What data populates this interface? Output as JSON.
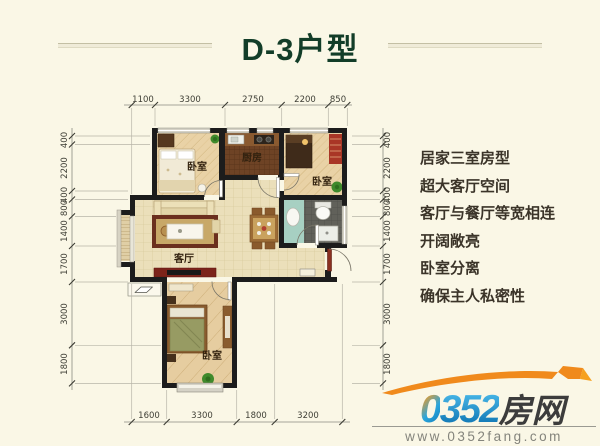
{
  "title": {
    "text": "D-3户型",
    "color": "#123d28"
  },
  "features": [
    "居家三室房型",
    "超大客厅空间",
    "客厅与餐厅等宽相连",
    "开阔敞亮",
    "卧室分离",
    "确保主人私密性"
  ],
  "plan": {
    "rooms": {
      "bedroom_top_left": "卧室",
      "kitchen": "厨房",
      "bedroom_top_right": "卧室",
      "living": "客厅",
      "bedroom_bottom": "卧室"
    },
    "dims": {
      "top": [
        "1100",
        "3300",
        "2750",
        "2200",
        "850"
      ],
      "bottom": [
        "1600",
        "3300",
        "1800",
        "3200"
      ],
      "left": [
        "400",
        "2200",
        "400",
        "800",
        "1400",
        "1700",
        "3000",
        "1800"
      ],
      "right": [
        "400",
        "2200",
        "400",
        "800",
        "1400",
        "1700",
        "3000",
        "1800"
      ]
    }
  },
  "logo": {
    "brand_zero": "0",
    "brand_number": "352",
    "brand_cn": "房网",
    "url": "www.0352fang.com",
    "orange": "#f28a1a",
    "blue": "#1186c6",
    "dark": "#3c3c3c"
  },
  "colors": {
    "background": "#faf7e6",
    "title_green": "#123d28",
    "wall_black": "#1c1c1c",
    "tile_floor": "#ebdfba",
    "wood_floor": "#e9d2a6",
    "kitchen_floor": "#6e4325",
    "bath_floor": "#61615a"
  }
}
